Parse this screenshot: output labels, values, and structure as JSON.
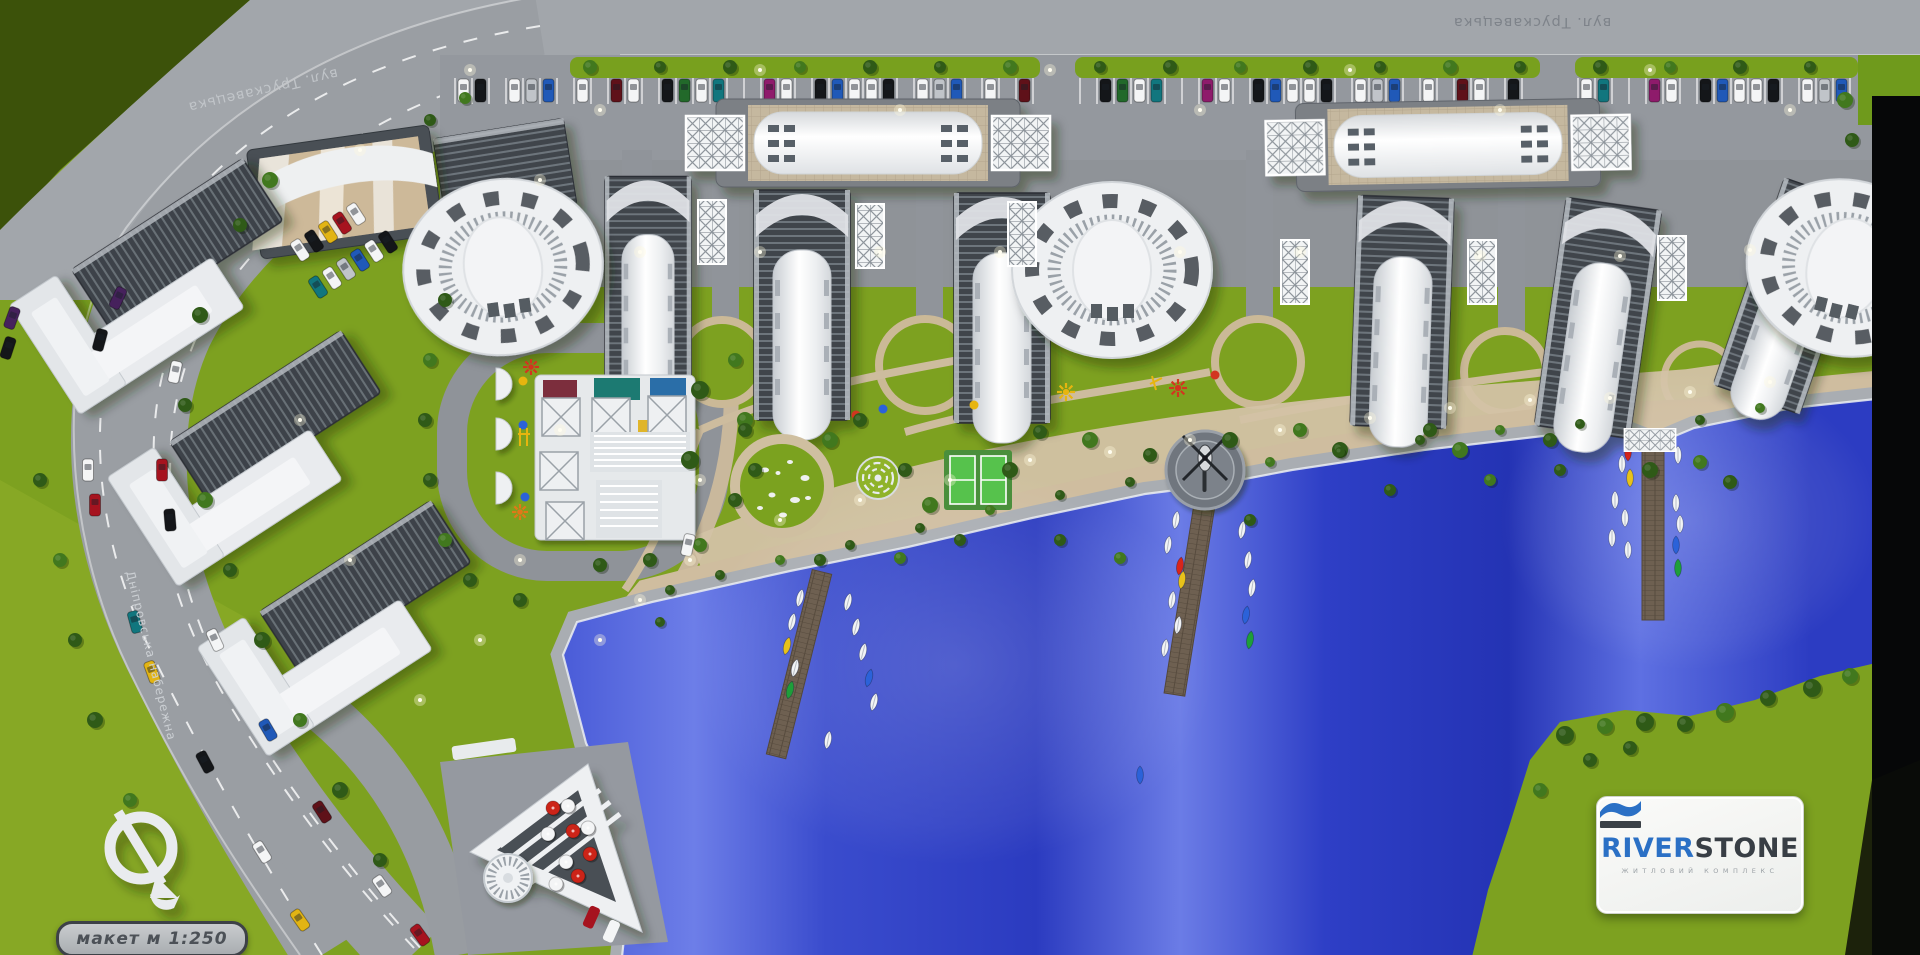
{
  "labels": {
    "street_top": "вул. Трускавецька",
    "street_left": "вул. Трускавецька",
    "embankment": "Дніпровська набережна"
  },
  "badge": {
    "scale_text": "макет м 1:250"
  },
  "logo": {
    "brand_primary": "RIVER",
    "brand_secondary": "STONE",
    "tagline": "ЖИТЛОВИЙ КОМПЛЕКС"
  },
  "palette": {
    "grass": "#7da120",
    "grass_dark": "#47610c",
    "grass_bright": "#8fae2a",
    "road": "#9a9ea3",
    "road_light": "#aaaeb3",
    "plaza": "#94989e",
    "water_deep": "#2734bf",
    "water_light": "#7584ea",
    "promenade": "#d0bfa1",
    "walkway": "#a9adb2",
    "building_white": "#eef0f2",
    "glass_dark": "#41454b",
    "pier": "#6e6051",
    "tree_dark": "#2f5a17",
    "tree_light": "#41781e",
    "lamp_glow": "#fff8dc",
    "logo_blue": "#2b70c5",
    "logo_dark": "#383e45",
    "umbrella_red": "#cc2418",
    "umbrella_white": "#f4f5f6",
    "boat_white": "#f2f4f6",
    "helipad": "#70767e"
  },
  "car_colors": [
    "#f4f5f6",
    "#141619",
    "#c0c4c9",
    "#a6131f",
    "#5f1119",
    "#2059b8",
    "#11767e",
    "#e2b414",
    "#46215c",
    "#22692a",
    "#8e1b6b"
  ],
  "boat_accents": [
    "#d8251b",
    "#e8c21a",
    "#1e9e3a",
    "#2b62d9"
  ],
  "playground_colors": [
    "#e7b50f",
    "#d2351f",
    "#e07818",
    "#2b62d9"
  ]
}
